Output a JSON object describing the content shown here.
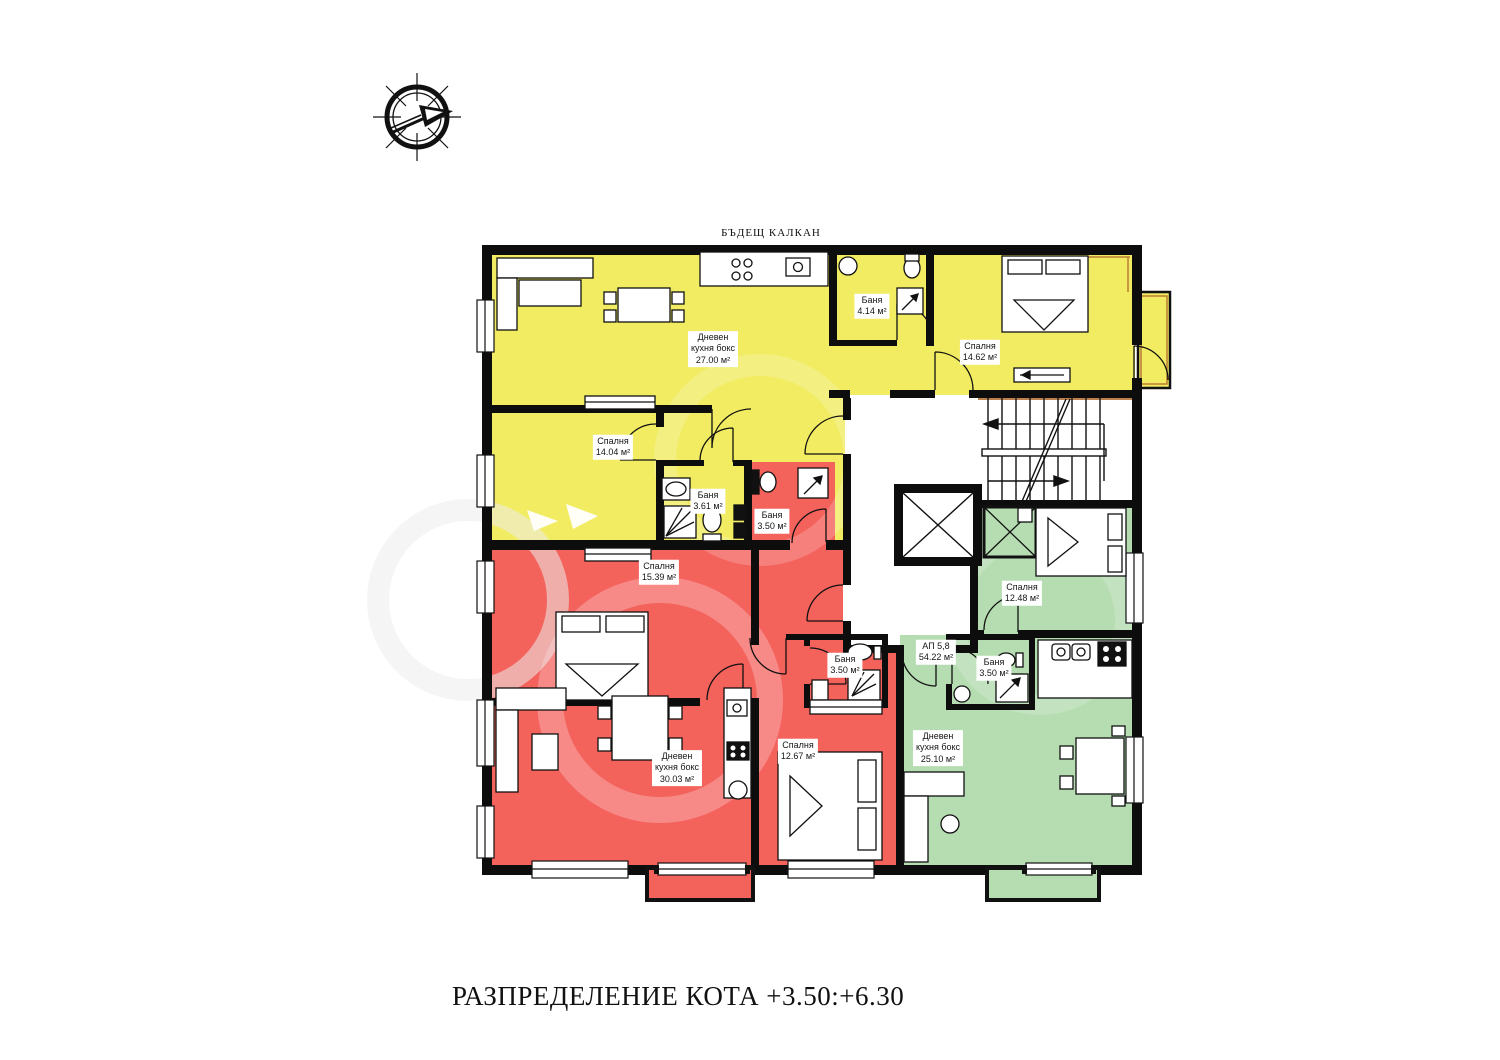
{
  "page": {
    "top_note": "БЪДЕЩ КАЛКАН",
    "title": "РАЗПРЕДЕЛЕНИЕ КОТА  +3.50:+6.30"
  },
  "colors": {
    "apt_yellow": "#f1ec62",
    "apt_red": "#f4625c",
    "apt_green": "#b6dcb1",
    "wall": "#0d0d0d",
    "accent": "#b06a2c",
    "paper": "#ffffff"
  },
  "room_labels": [
    {
      "id": "yellow-living",
      "lines": [
        "Дневен",
        "кухня бокс",
        "27.00 м²"
      ]
    },
    {
      "id": "yellow-bath-1",
      "lines": [
        "Баня",
        "4.14 м²"
      ]
    },
    {
      "id": "yellow-bedroom-right",
      "lines": [
        "Спалня",
        "14.62 м²"
      ]
    },
    {
      "id": "yellow-bedroom-left",
      "lines": [
        "Спалня",
        "14.04 м²"
      ]
    },
    {
      "id": "yellow-bath-2",
      "lines": [
        "Баня",
        "3.61 м²"
      ]
    },
    {
      "id": "red-bath-upper",
      "lines": [
        "Баня",
        "3.50 м²"
      ]
    },
    {
      "id": "red-bedroom-1",
      "lines": [
        "Спалня",
        "15.39 м²"
      ]
    },
    {
      "id": "red-bath-lower",
      "lines": [
        "Баня",
        "3.50 м²"
      ]
    },
    {
      "id": "red-living",
      "lines": [
        "Дневен",
        "кухня бокс",
        "30.03 м²"
      ]
    },
    {
      "id": "red-bedroom-2",
      "lines": [
        "Спалня",
        "12.67 м²"
      ]
    },
    {
      "id": "green-bedroom",
      "lines": [
        "Спалня",
        "12.48 м²"
      ]
    },
    {
      "id": "green-apartment",
      "lines": [
        "АП 5,8",
        "54.22 м²"
      ]
    },
    {
      "id": "green-bath",
      "lines": [
        "Баня",
        "3.50 м²"
      ]
    },
    {
      "id": "green-living",
      "lines": [
        "Дневен",
        "кухня бокс",
        "25.10 м²"
      ]
    }
  ]
}
